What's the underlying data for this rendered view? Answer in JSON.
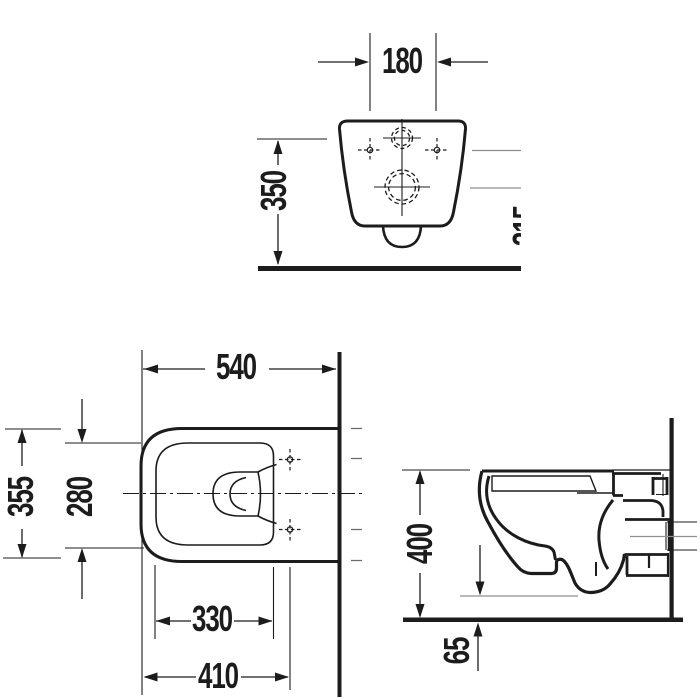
{
  "drawing": {
    "kind": "technical-dimension-drawing",
    "background": "#ffffff",
    "line_color": "#1c1c1c",
    "gray_line_color": "#8f8f8f"
  },
  "views": {
    "rear": {
      "dims": {
        "d180": "180",
        "d350": "350",
        "d315_clipped": "315"
      }
    },
    "plan": {
      "dims": {
        "d540": "540",
        "d355": "355",
        "d280": "280",
        "d330": "330",
        "d410": "410"
      }
    },
    "side": {
      "dims": {
        "d400": "400",
        "d65": "65"
      }
    }
  }
}
